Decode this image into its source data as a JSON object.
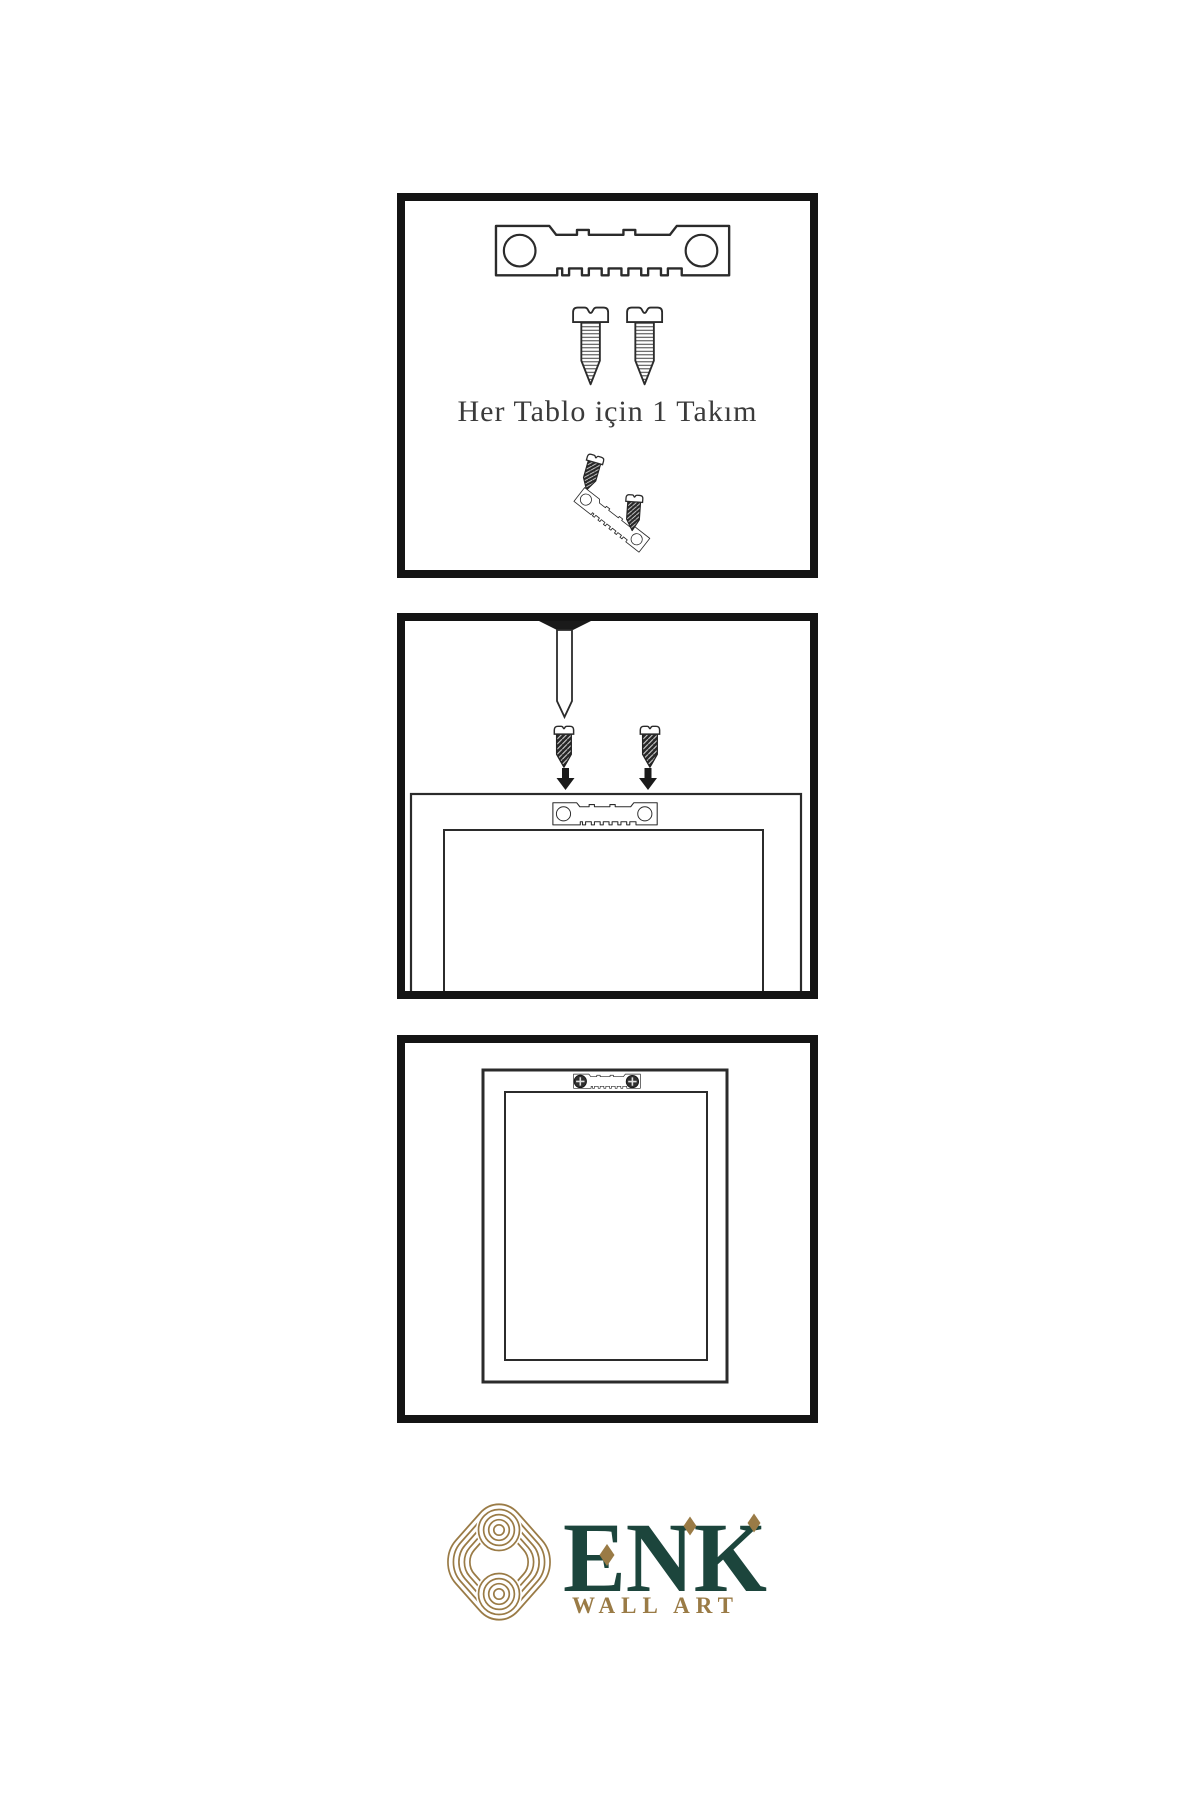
{
  "colors": {
    "background": "#ffffff",
    "line": "#2b2b2b",
    "ink": "#1a1a1a",
    "panel-border": "#141414",
    "brand-green": "#1c453c",
    "brand-gold": "#9a7b46",
    "caption-text": "#3b3b3b"
  },
  "caption": {
    "text": "Her Tablo için 1 Takım"
  },
  "brand": {
    "name": "ENK",
    "subtitle": "WALL ART"
  },
  "panels": [
    {
      "step": 1,
      "illustrations": [
        "sawtooth-hanger-icon",
        "screw-icon",
        "screw-icon",
        "screw-into-hanger-assembly-icon"
      ]
    },
    {
      "step": 2,
      "illustrations": [
        "nail-icon",
        "screw-icon",
        "screw-icon",
        "arrow-down-icon",
        "arrow-down-icon",
        "frame-back-icon",
        "sawtooth-hanger-icon"
      ]
    },
    {
      "step": 3,
      "illustrations": [
        "frame-back-icon",
        "sawtooth-hanger-installed-icon",
        "phillips-screw-head-icon",
        "phillips-screw-head-icon"
      ]
    }
  ]
}
